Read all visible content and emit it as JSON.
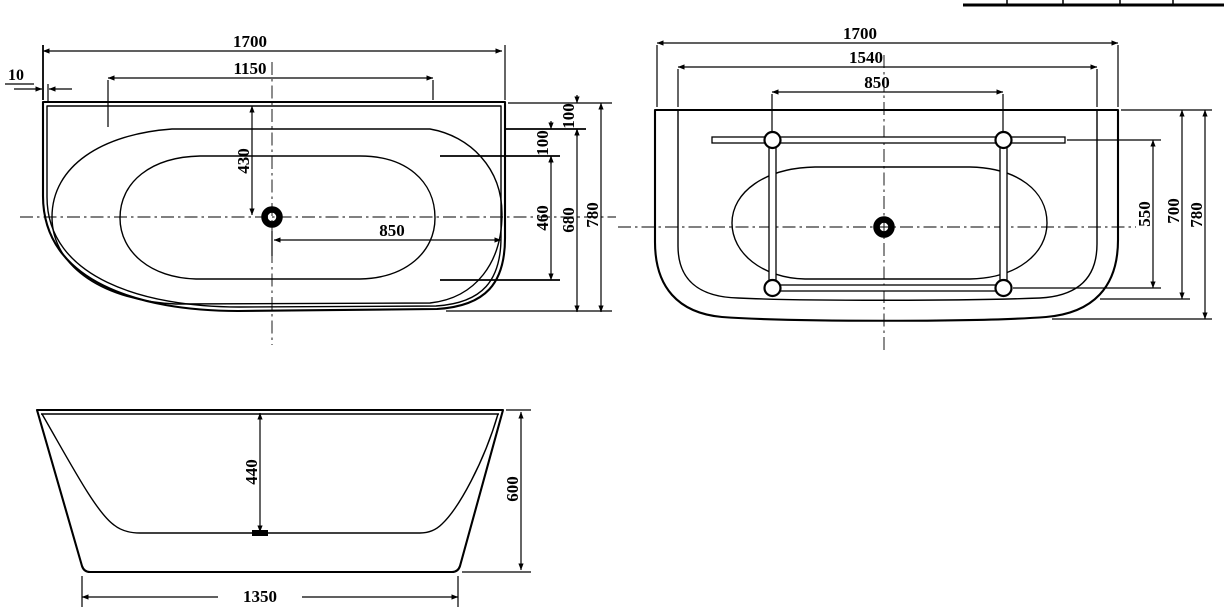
{
  "colors": {
    "line": "#000000",
    "background": "#ffffff"
  },
  "drawing": {
    "views": {
      "plan": {
        "dims": {
          "overall_length": "1700",
          "inner_length": "1150",
          "wall_gap": "10",
          "drain_to_back": "430",
          "drain_to_right": "850",
          "back_rim": "100",
          "inner_rim": "100",
          "well_width": "460",
          "inner_width": "680",
          "overall_width": "780"
        }
      },
      "bottom": {
        "dims": {
          "overall_length": "1700",
          "base_length": "1540",
          "feet_span": "850",
          "feet_width": "550",
          "base_width": "700",
          "overall_width": "780"
        }
      },
      "elevation": {
        "dims": {
          "inner_depth": "440",
          "overall_height": "600",
          "base_length": "1350"
        }
      }
    }
  }
}
